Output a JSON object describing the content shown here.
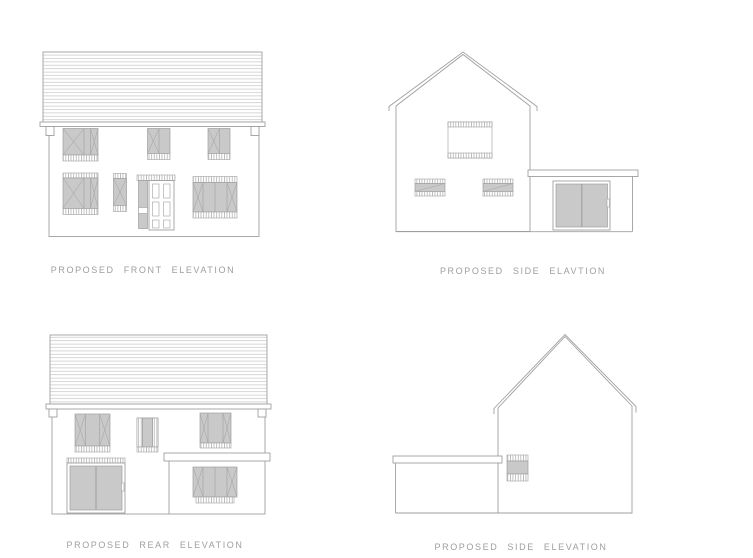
{
  "colors": {
    "line": "#9f9f9f",
    "roof_line": "#c6c6c6",
    "glass": "#c9c9c9",
    "hatch": "#a8a8a8",
    "label": "#9e9e9e",
    "bg": "#ffffff"
  },
  "elevations": [
    {
      "id": "front",
      "label": "PROPOSED FRONT ELEVATION"
    },
    {
      "id": "side_top",
      "label": "PROPOSED SIDE ELAVTION"
    },
    {
      "id": "rear",
      "label": "PROPOSED REAR ELEVATION"
    },
    {
      "id": "side_bottom",
      "label": "PROPOSED SIDE ELEVATION"
    }
  ]
}
